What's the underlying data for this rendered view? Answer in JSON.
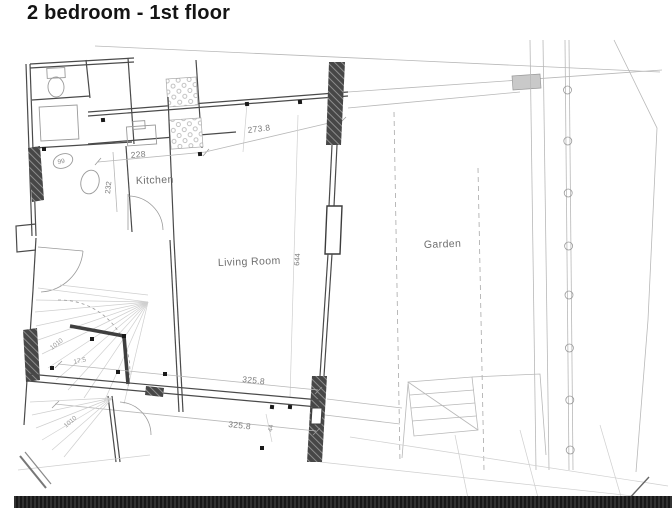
{
  "page": {
    "title": "2 bedroom - 1st floor"
  },
  "plan": {
    "room_labels": {
      "kitchen": "Kitchen",
      "living_room": "Living Room",
      "garden": "Garden"
    },
    "dimensions": {
      "corridor_length": "273.8",
      "kitchen_width": "228",
      "kitchen_side": "232",
      "living_length": "644",
      "lower_wall_upper": "325.8",
      "lower_wall_lower": "325.8",
      "door_width": "44",
      "hall_mark": "99",
      "stair_note_upper": "1010",
      "stair_tread": "17.5",
      "stair_note_lower": "1010"
    },
    "colors": {
      "wall": "#4a4a4a",
      "pier_hatch": "#474747",
      "light_line": "#b8b8b8",
      "label_text": "#6f6f6f",
      "footer_bar": "#1f1f1f"
    }
  }
}
